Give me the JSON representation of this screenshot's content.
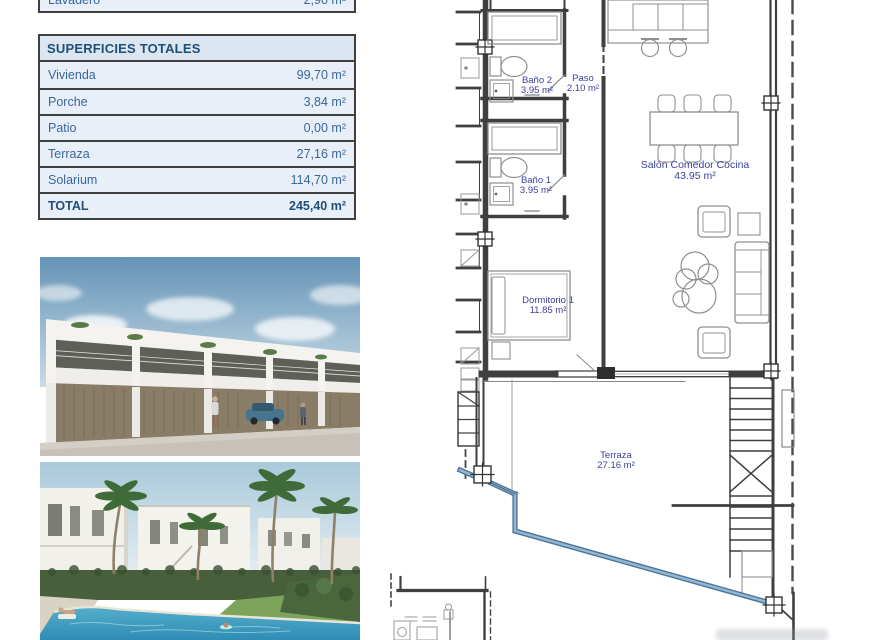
{
  "cutoff_table": {
    "row": {
      "label": "Lavadero",
      "value": "2,90 m²"
    }
  },
  "totals_table": {
    "title": "SUPERFICIES TOTALES",
    "rows": [
      {
        "label": "Vivienda",
        "value": "99,70 m²"
      },
      {
        "label": "Porche",
        "value": "3,84 m²"
      },
      {
        "label": "Patio",
        "value": "0,00 m²"
      },
      {
        "label": "Terraza",
        "value": "27,16 m²"
      },
      {
        "label": "Solarium",
        "value": "114,70 m²"
      },
      {
        "label": "TOTAL",
        "value": "245,40 m²"
      }
    ]
  },
  "floorplan": {
    "rooms": [
      {
        "name": "Baño 2",
        "area": "3.95 m²"
      },
      {
        "name": "Paso",
        "area": "2.10 m²"
      },
      {
        "name": "Baño 1",
        "area": "3.95 m²"
      },
      {
        "name": "Salón Comedor Cocina",
        "area": "43.95 m²"
      },
      {
        "name": "Dormitorio 1",
        "area": "11.85 m²"
      },
      {
        "name": "Terraza",
        "area": "27.16 m²"
      }
    ]
  },
  "colors": {
    "table_header_text": "#1f4e79",
    "table_row_text": "#38679b",
    "table_header_bg": "#dce6f1",
    "table_row_bg": "#e9eff8",
    "table_border": "#404040",
    "plan_wall": "#3f3f3f",
    "plan_furniture": "#8f8f8f",
    "plan_label_text": "#3a3f9c",
    "boundary_blue": "#7ba3c6"
  }
}
